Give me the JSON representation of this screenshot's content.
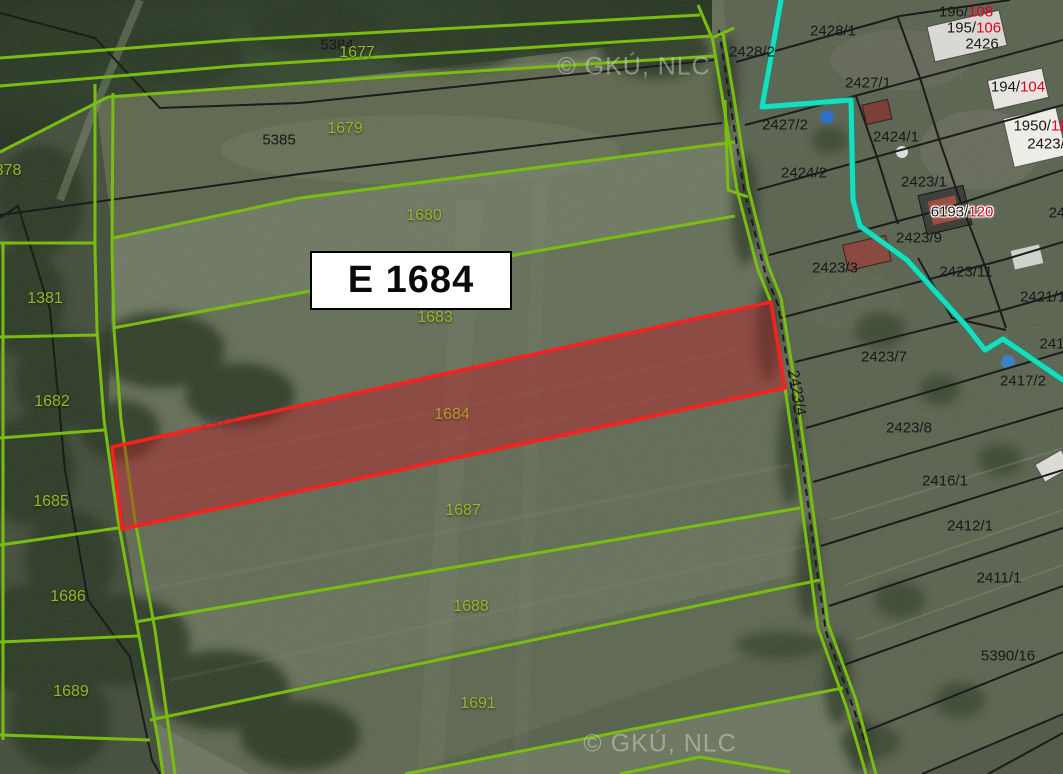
{
  "map": {
    "watermark": "© GKÚ, NLC",
    "highlight": {
      "label": "E 1684",
      "parcel_number": "1684"
    },
    "colors": {
      "boundary_green": "#79bd10",
      "boundary_black": "#1c1c1c",
      "utility_cyan": "#17dfbe",
      "highlight_red": "#fb2020",
      "label_green": "#9cb32b",
      "label_gold": "#b8992e",
      "label_red": "#e30022"
    },
    "labels": [
      {
        "text": "5384",
        "x": 337,
        "y": 45,
        "cls": "black"
      },
      {
        "text": "1677",
        "x": 357,
        "y": 53,
        "cls": "green"
      },
      {
        "text": "© GKÚ, NLC",
        "x": 634,
        "y": 67,
        "cls": "watermark"
      },
      {
        "text": "5385",
        "x": 279,
        "y": 140,
        "cls": "black"
      },
      {
        "text": "1679",
        "x": 345,
        "y": 129,
        "cls": "green"
      },
      {
        "text": "378",
        "x": 8,
        "y": 171,
        "cls": "green"
      },
      {
        "text": "1680",
        "x": 424,
        "y": 216,
        "cls": "green"
      },
      {
        "text": "1381",
        "x": 45,
        "y": 299,
        "cls": "green"
      },
      {
        "text": "1683",
        "x": 435,
        "y": 318,
        "cls": "green"
      },
      {
        "text": "1682",
        "x": 52,
        "y": 402,
        "cls": "green"
      },
      {
        "text": "2922",
        "x": 219,
        "y": 422,
        "cls": "gray",
        "rot": -8
      },
      {
        "text": "1684",
        "x": 452,
        "y": 415,
        "cls": "gold"
      },
      {
        "text": "1685",
        "x": 51,
        "y": 502,
        "cls": "green"
      },
      {
        "text": "1687",
        "x": 463,
        "y": 511,
        "cls": "green"
      },
      {
        "text": "1686",
        "x": 68,
        "y": 597,
        "cls": "green"
      },
      {
        "text": "1688",
        "x": 471,
        "y": 607,
        "cls": "green"
      },
      {
        "text": "1689",
        "x": 71,
        "y": 692,
        "cls": "green"
      },
      {
        "text": "1691",
        "x": 478,
        "y": 704,
        "cls": "green"
      },
      {
        "text": "© GKÚ, NLC",
        "x": 660,
        "y": 744,
        "cls": "watermark"
      },
      {
        "text": "2428/1",
        "x": 833,
        "y": 31,
        "cls": "black"
      },
      {
        "text": "2428/2",
        "x": 752,
        "y": 52,
        "cls": "black"
      },
      {
        "text": "196/",
        "red": "108",
        "x": 966,
        "y": 12,
        "cls": "black"
      },
      {
        "text": "195/",
        "red": "106",
        "x": 974,
        "y": 28,
        "cls": "black"
      },
      {
        "text": "2426",
        "x": 982,
        "y": 44,
        "cls": "black"
      },
      {
        "text": "2427/1",
        "x": 868,
        "y": 83,
        "cls": "black"
      },
      {
        "text": "194/",
        "red": "104",
        "x": 1018,
        "y": 87,
        "cls": "black"
      },
      {
        "text": "2427/2",
        "x": 785,
        "y": 125,
        "cls": "black"
      },
      {
        "text": "2424/1",
        "x": 896,
        "y": 137,
        "cls": "black"
      },
      {
        "text": "1950/",
        "red": "11",
        "x": 1040,
        "y": 126,
        "cls": "black"
      },
      {
        "text": "2423/",
        "x": 1046,
        "y": 144,
        "cls": "black"
      },
      {
        "text": "2424/2",
        "x": 804,
        "y": 173,
        "cls": "black"
      },
      {
        "text": "2423/1",
        "x": 924,
        "y": 182,
        "cls": "black"
      },
      {
        "text": "6193/",
        "red": "120",
        "x": 962,
        "y": 212,
        "cls": "black",
        "plate": true
      },
      {
        "text": "24",
        "x": 1057,
        "y": 213,
        "cls": "black"
      },
      {
        "text": "2423/9",
        "x": 919,
        "y": 238,
        "cls": "black"
      },
      {
        "text": "2423/3",
        "x": 835,
        "y": 268,
        "cls": "black"
      },
      {
        "text": "2423/11",
        "x": 966,
        "y": 272,
        "cls": "black"
      },
      {
        "text": "2421/1",
        "x": 1043,
        "y": 297,
        "cls": "black"
      },
      {
        "text": "2423/7",
        "x": 884,
        "y": 357,
        "cls": "black"
      },
      {
        "text": "241",
        "x": 1052,
        "y": 344,
        "cls": "black"
      },
      {
        "text": "2417/2",
        "x": 1023,
        "y": 381,
        "cls": "black"
      },
      {
        "text": "2423/4",
        "x": 797,
        "y": 393,
        "cls": "black",
        "rot": 80
      },
      {
        "text": "2423/8",
        "x": 909,
        "y": 428,
        "cls": "black"
      },
      {
        "text": "2416/1",
        "x": 945,
        "y": 481,
        "cls": "black"
      },
      {
        "text": "2412/1",
        "x": 970,
        "y": 526,
        "cls": "black"
      },
      {
        "text": "2411/1",
        "x": 999,
        "y": 578,
        "cls": "black"
      },
      {
        "text": "5390/16",
        "x": 1008,
        "y": 656,
        "cls": "black"
      }
    ]
  }
}
